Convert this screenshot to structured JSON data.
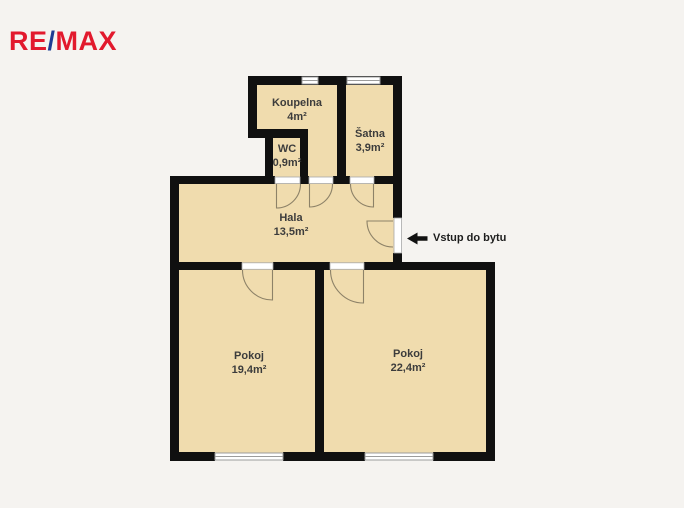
{
  "logo": {
    "re": "RE",
    "slash": "/",
    "max": "MAX"
  },
  "colors": {
    "logo_red": "#e2192d",
    "logo_blue": "#1d3c93",
    "room_fill": "#f0dcae",
    "wall": "#101010",
    "background": "#f5f3f0",
    "text": "#3c3c3c",
    "door_arc": "#8d8268",
    "window_frame": "#9c9c9c"
  },
  "rooms": [
    {
      "id": "koupelna",
      "name": "Koupelna",
      "area": "4m²"
    },
    {
      "id": "satna",
      "name": "Šatna",
      "area": "3,9m²"
    },
    {
      "id": "wc",
      "name": "WC",
      "area": "0,9m²"
    },
    {
      "id": "hala",
      "name": "Hala",
      "area": "13,5m²"
    },
    {
      "id": "pokoj-left",
      "name": "Pokoj",
      "area": "19,4m²"
    },
    {
      "id": "pokoj-right",
      "name": "Pokoj",
      "area": "22,4m²"
    }
  ],
  "entrance": {
    "label": "Vstup do bytu"
  }
}
